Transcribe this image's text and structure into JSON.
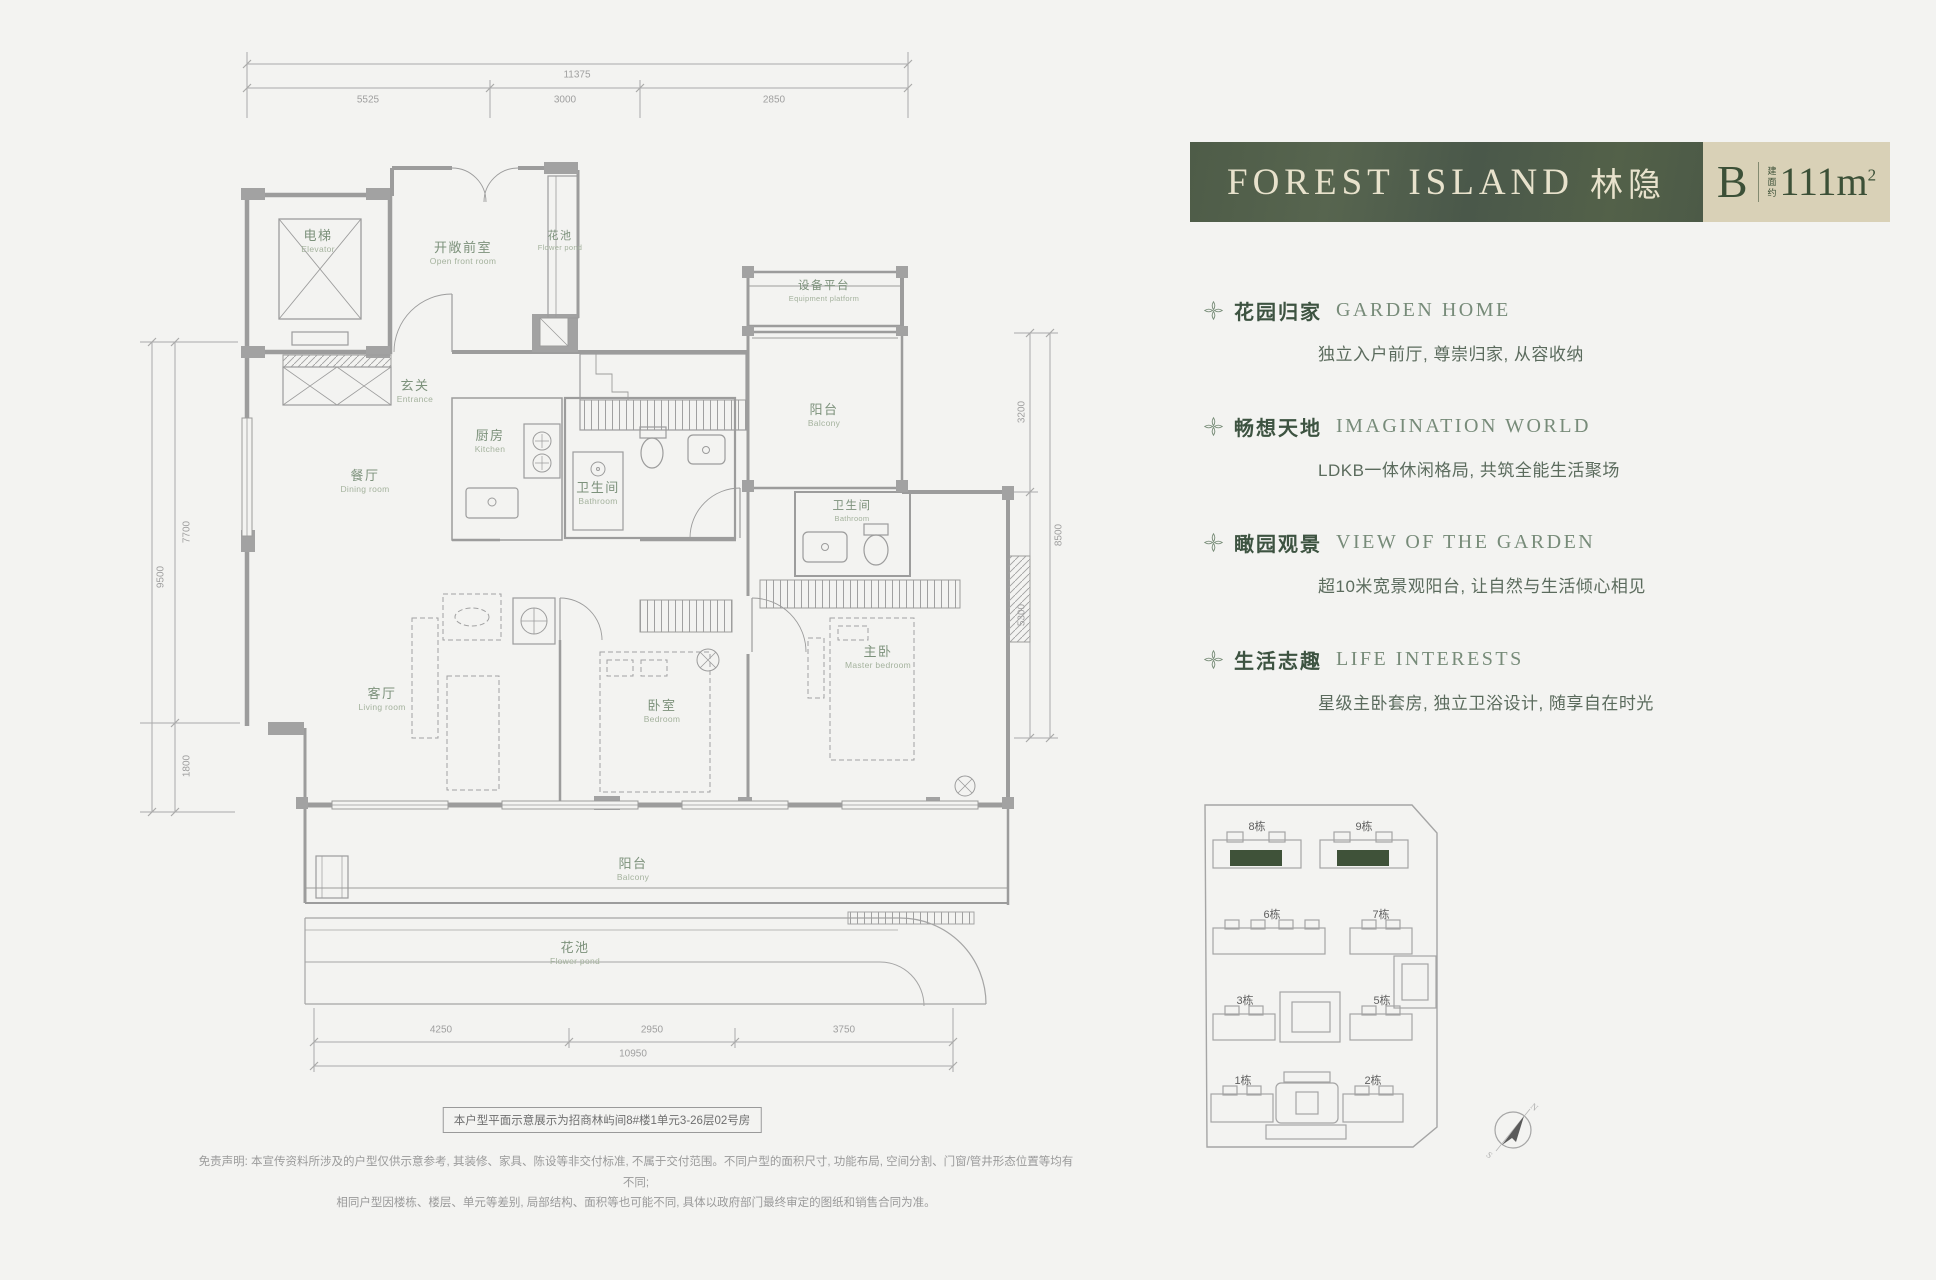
{
  "banner": {
    "title_en": "FOREST ISLAND",
    "title_cn": "林隐",
    "unit": "B",
    "area_label": "建面约",
    "area_value": "111m",
    "area_sup": "2",
    "green_color": "#4e5c48",
    "beige_color": "#d9d1b7"
  },
  "features": [
    {
      "cn": "花园归家",
      "en": "GARDEN HOME",
      "desc": "独立入户前厅, 尊崇归家, 从容收纳"
    },
    {
      "cn": "畅想天地",
      "en": "IMAGINATION WORLD",
      "desc": "LDKB一体休闲格局, 共筑全能生活聚场"
    },
    {
      "cn": "瞰园观景",
      "en": "VIEW OF THE GARDEN",
      "desc": "超10米宽景观阳台, 让自然与生活倾心相见"
    },
    {
      "cn": "生活志趣",
      "en": "LIFE INTERESTS",
      "desc": "星级主卧套房, 独立卫浴设计, 随享自在时光"
    }
  ],
  "floorplan": {
    "rooms": [
      {
        "cn": "电梯",
        "en": "Elevator"
      },
      {
        "cn": "开敞前室",
        "en": "Open front room"
      },
      {
        "cn": "花池",
        "en": "Flower pond"
      },
      {
        "cn": "玄关",
        "en": "Entrance"
      },
      {
        "cn": "厨房",
        "en": "Kitchen"
      },
      {
        "cn": "餐厅",
        "en": "Dining room"
      },
      {
        "cn": "卫生间",
        "en": "Bathroom"
      },
      {
        "cn": "设备平台",
        "en": "Equipment platform"
      },
      {
        "cn": "阳台",
        "en": "Balcony"
      },
      {
        "cn": "卫生间",
        "en": "Bathroom"
      },
      {
        "cn": "客厅",
        "en": "Living room"
      },
      {
        "cn": "卧室",
        "en": "Bedroom"
      },
      {
        "cn": "主卧",
        "en": "Master bedroom"
      },
      {
        "cn": "阳台",
        "en": "Balcony"
      },
      {
        "cn": "花池",
        "en": "Flower pond"
      }
    ],
    "dims": {
      "t_total": "11375",
      "t1": "5525",
      "t2": "3000",
      "t3": "2850",
      "l_total": "9500",
      "l1": "7700",
      "l2": "1800",
      "r1": "3200",
      "r2": "5300",
      "r_total": "8500",
      "b1": "4250",
      "b2": "2950",
      "b3": "3750",
      "b_total": "10950"
    },
    "note": "本户型平面示意展示为招商林屿间8#楼1单元3-26层02号房"
  },
  "siteplan": {
    "buildings": [
      {
        "label": "8栋"
      },
      {
        "label": "9栋"
      },
      {
        "label": "6栋"
      },
      {
        "label": "7栋"
      },
      {
        "label": "3栋"
      },
      {
        "label": "5栋"
      },
      {
        "label": "1栋"
      },
      {
        "label": "2栋"
      }
    ],
    "highlight_color": "#3f5239",
    "compass": {
      "n": "N",
      "s": "S"
    }
  },
  "disclaimer": {
    "line1": "免责声明: 本宣传资料所涉及的户型仅供示意参考, 其装修、家具、陈设等非交付标准, 不属于交付范围。不同户型的面积尺寸, 功能布局, 空间分割、门窗/管井形态位置等均有不同;",
    "line2": "相同户型因楼栋、楼层、单元等差别, 局部结构、面积等也可能不同, 具体以政府部门最终审定的图纸和销售合同为准。"
  }
}
